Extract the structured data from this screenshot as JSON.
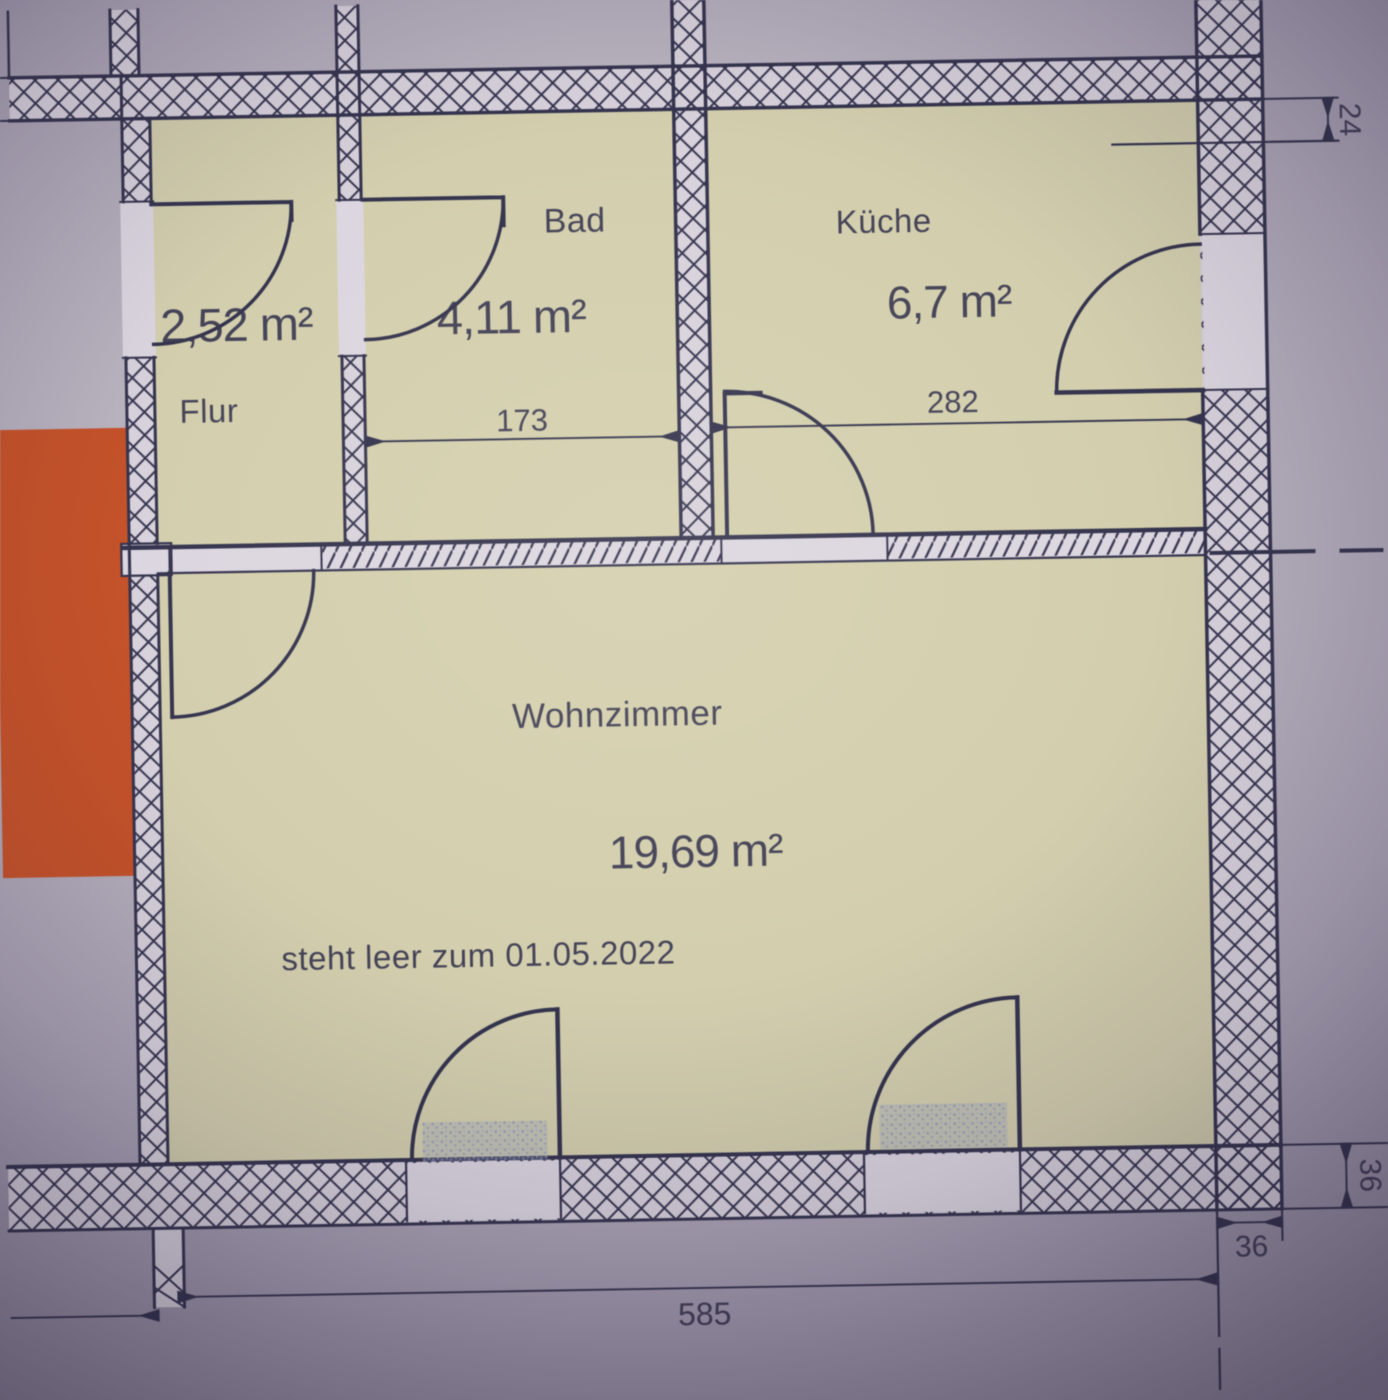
{
  "rooms": {
    "flur": {
      "name": "Flur",
      "area": "2,52 m²"
    },
    "bad": {
      "name": "Bad",
      "area": "4,11 m²"
    },
    "kueche": {
      "name": "Küche",
      "area": "6,7 m²"
    },
    "wohnzimmer": {
      "name": "Wohnzimmer",
      "area": "19,69 m²",
      "vacancy_note": "steht leer zum 01.05.2022"
    }
  },
  "dimensions_cm": {
    "bad_interior_width": "173",
    "kueche_interior_width": "282",
    "apartment_total_width": "585",
    "top_wall_thickness": "24",
    "right_wall_thickness": "36",
    "bottom_wall_thickness": "36"
  },
  "colors": {
    "line": "#35344e",
    "floor": "#d3cfae",
    "wall_fill": "#d8d2dc",
    "opening_fill": "#dcd6e0",
    "paper": "#b7b0bd",
    "orange_block": "#c4522a",
    "threshold": "#939dbd"
  }
}
